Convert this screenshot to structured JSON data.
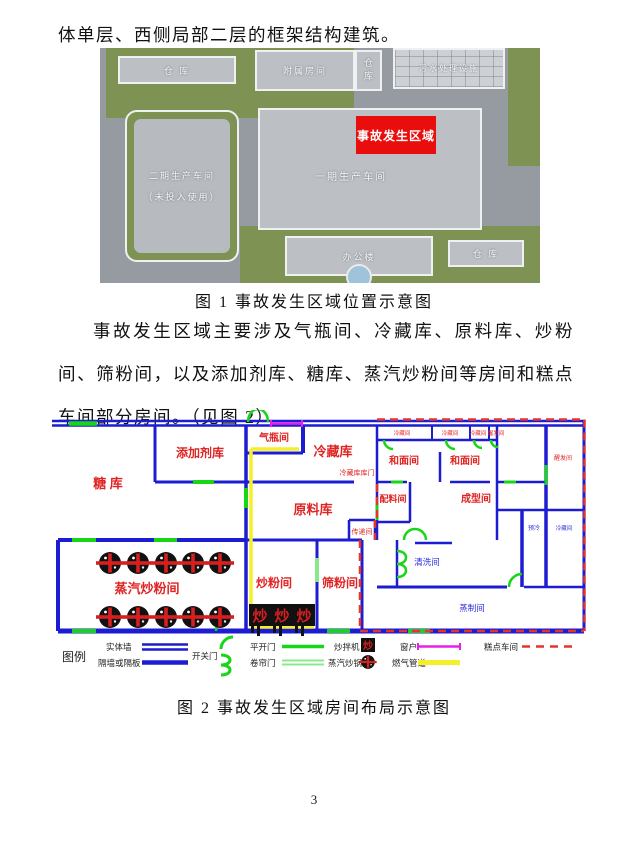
{
  "page": {
    "top_paragraph": "体单层、西侧局部二层的框架结构建筑。",
    "middle_paragraph": "事故发生区域主要涉及气瓶间、冷藏库、原料库、炒粉间、筛粉间，以及添加剂库、糖库、蒸汽炒粉间等房间和糕点车间部分房间。（见图 2）",
    "page_number": "3"
  },
  "figure1": {
    "caption": "图 1  事故发生区域位置示意图",
    "labels": {
      "warehouse_top_left": "仓 库",
      "attached_rooms": "附属房间",
      "warehouse_top_mid": "仓库",
      "sewage_facility": "污水处理设施",
      "phase2_line1": "二期生产车间",
      "phase2_line2": "（未投入使用）",
      "phase1_workshop": "一期生产车间",
      "accident_area": "事故发生区域",
      "office_building": "办公楼",
      "warehouse_bottom_right": "仓 库"
    },
    "colors": {
      "accident_red": "#ea0d0d"
    }
  },
  "figure2": {
    "caption": "图 2  事故发生区域房间布局示意图",
    "rooms": {
      "sugar_store": "糖 库",
      "additive_store": "添加剂库",
      "gas_cylinder_room": "气瓶间",
      "cold_storage": "冷藏库",
      "cold_storage_door": "冷藏库库门",
      "raw_material_store": "原料库",
      "transfer_room": "传递间",
      "batching_room": "配料间",
      "dough_room_left": "和面间",
      "dough_room_right": "和面间",
      "forming_room": "成型间",
      "cold_room_1": "冷藏间",
      "cold_room_2": "冷藏间",
      "cold_room_3": "冷藏间",
      "proofing_room_top": "醒发间",
      "proofing_room_right": "醒发间",
      "precool_room": "预冷",
      "cold_room_right": "冷藏间",
      "washing_room": "清洗间",
      "steaming_room": "蒸制间",
      "sifting_room": "筛粉间",
      "stirfry_room": "炒粉间",
      "steam_stirfry_room": "蒸汽炒粉间"
    },
    "equipment": {
      "steam_wok_count": 10,
      "mixer_count": 3,
      "mixer_glyph": "炒"
    },
    "legend": {
      "title": "图例",
      "solid_wall": "实体墙",
      "partition_wall": "隔墙或隔板",
      "swing_door": "开关门",
      "flat_door": "平开门",
      "rolling_door": "卷帘门",
      "mixer": "炒拌机",
      "steam_wok": "蒸汽炒锅",
      "window": "窗户",
      "gas_pipeline": "燃气管道",
      "cake_workshop": "糕点车间"
    },
    "colors": {
      "wall_blue": "#1c1cd2",
      "door_green": "#17d517",
      "rolling_green": "#8ce88c",
      "window_magenta": "#e621e6",
      "gas_yellow": "#f4ef2a",
      "boundary_red": "#e5342a",
      "label_red": "#e02424",
      "label_blue": "#2b2bdf"
    }
  }
}
